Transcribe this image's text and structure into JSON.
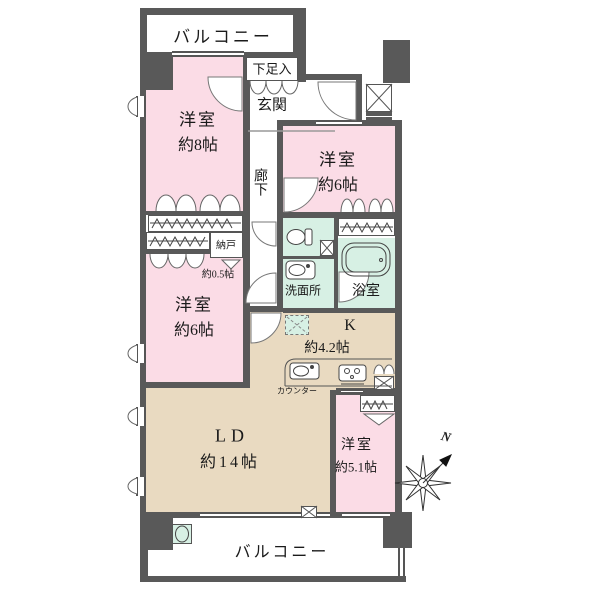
{
  "floorplan": {
    "balcony_top": {
      "label": "バルコニー"
    },
    "shoe_cabinet": {
      "label": "下足入"
    },
    "entrance": {
      "label": "玄関"
    },
    "corridor": {
      "label": "廊下"
    },
    "bedroom_8": {
      "label": "洋室",
      "size": "約8帖"
    },
    "bedroom_6_right": {
      "label": "洋室",
      "size": "約6帖"
    },
    "storage": {
      "label": "納戸",
      "size": "約0.5帖"
    },
    "bedroom_6_left": {
      "label": "洋室",
      "size": "約6帖"
    },
    "washroom": {
      "label": "洗面所"
    },
    "bathroom": {
      "label": "浴室"
    },
    "kitchen": {
      "label": "K",
      "size": "約4.2帖"
    },
    "counter": {
      "label": "カウンター"
    },
    "living_dining": {
      "label": "LD",
      "size": "約14帖"
    },
    "bedroom_5": {
      "label": "洋室",
      "size": "約5.1帖"
    },
    "balcony_bottom": {
      "label": "バルコニー"
    },
    "compass": {
      "label": "N"
    },
    "colors": {
      "bedroom": "#fbdce6",
      "living_dining": "#e9dac1",
      "wet_area": "#d7f0e4",
      "wall": "#595959"
    }
  }
}
